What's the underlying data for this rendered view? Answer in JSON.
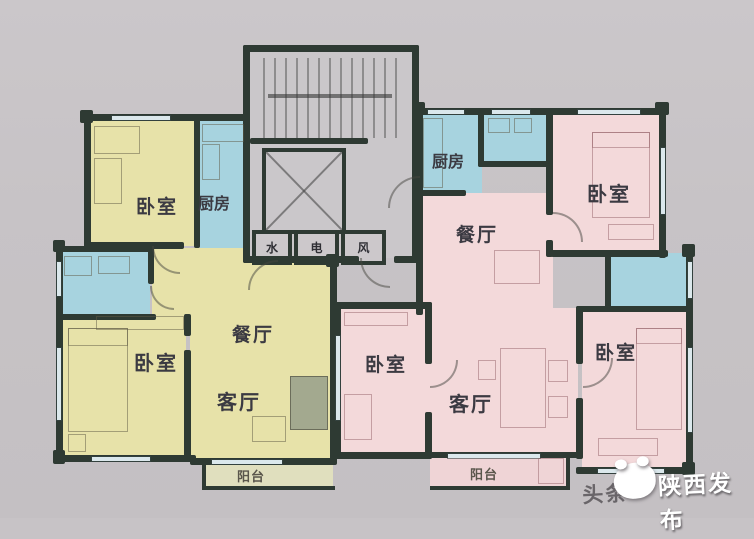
{
  "palette": {
    "bg": "#c7c3c6",
    "wall": "#2e3a33",
    "yellow": "#e7e2a9",
    "blue": "#a7d3df",
    "pink": "#f3d9da",
    "balcony": "#e0dfbe",
    "core": "#cac7ca",
    "label": "#3b3a42"
  },
  "rooms": {
    "bedroom_tl": "卧室",
    "kitchen_l": "厨房",
    "bedroom_l": "卧室",
    "dining_l": "餐厅",
    "living_l": "客厅",
    "balcony_l": "阳台",
    "kitchen_r": "厨房",
    "dining_r": "餐厅",
    "bedroom_tr": "卧室",
    "bedroom_m": "卧室",
    "living_r": "客厅",
    "bedroom_br": "卧室",
    "balcony_br": "阳台"
  },
  "shafts": {
    "water": "水",
    "electric": "电",
    "vent": "风"
  },
  "watermark": {
    "platform": "头条",
    "publisher": "陕西发布"
  }
}
